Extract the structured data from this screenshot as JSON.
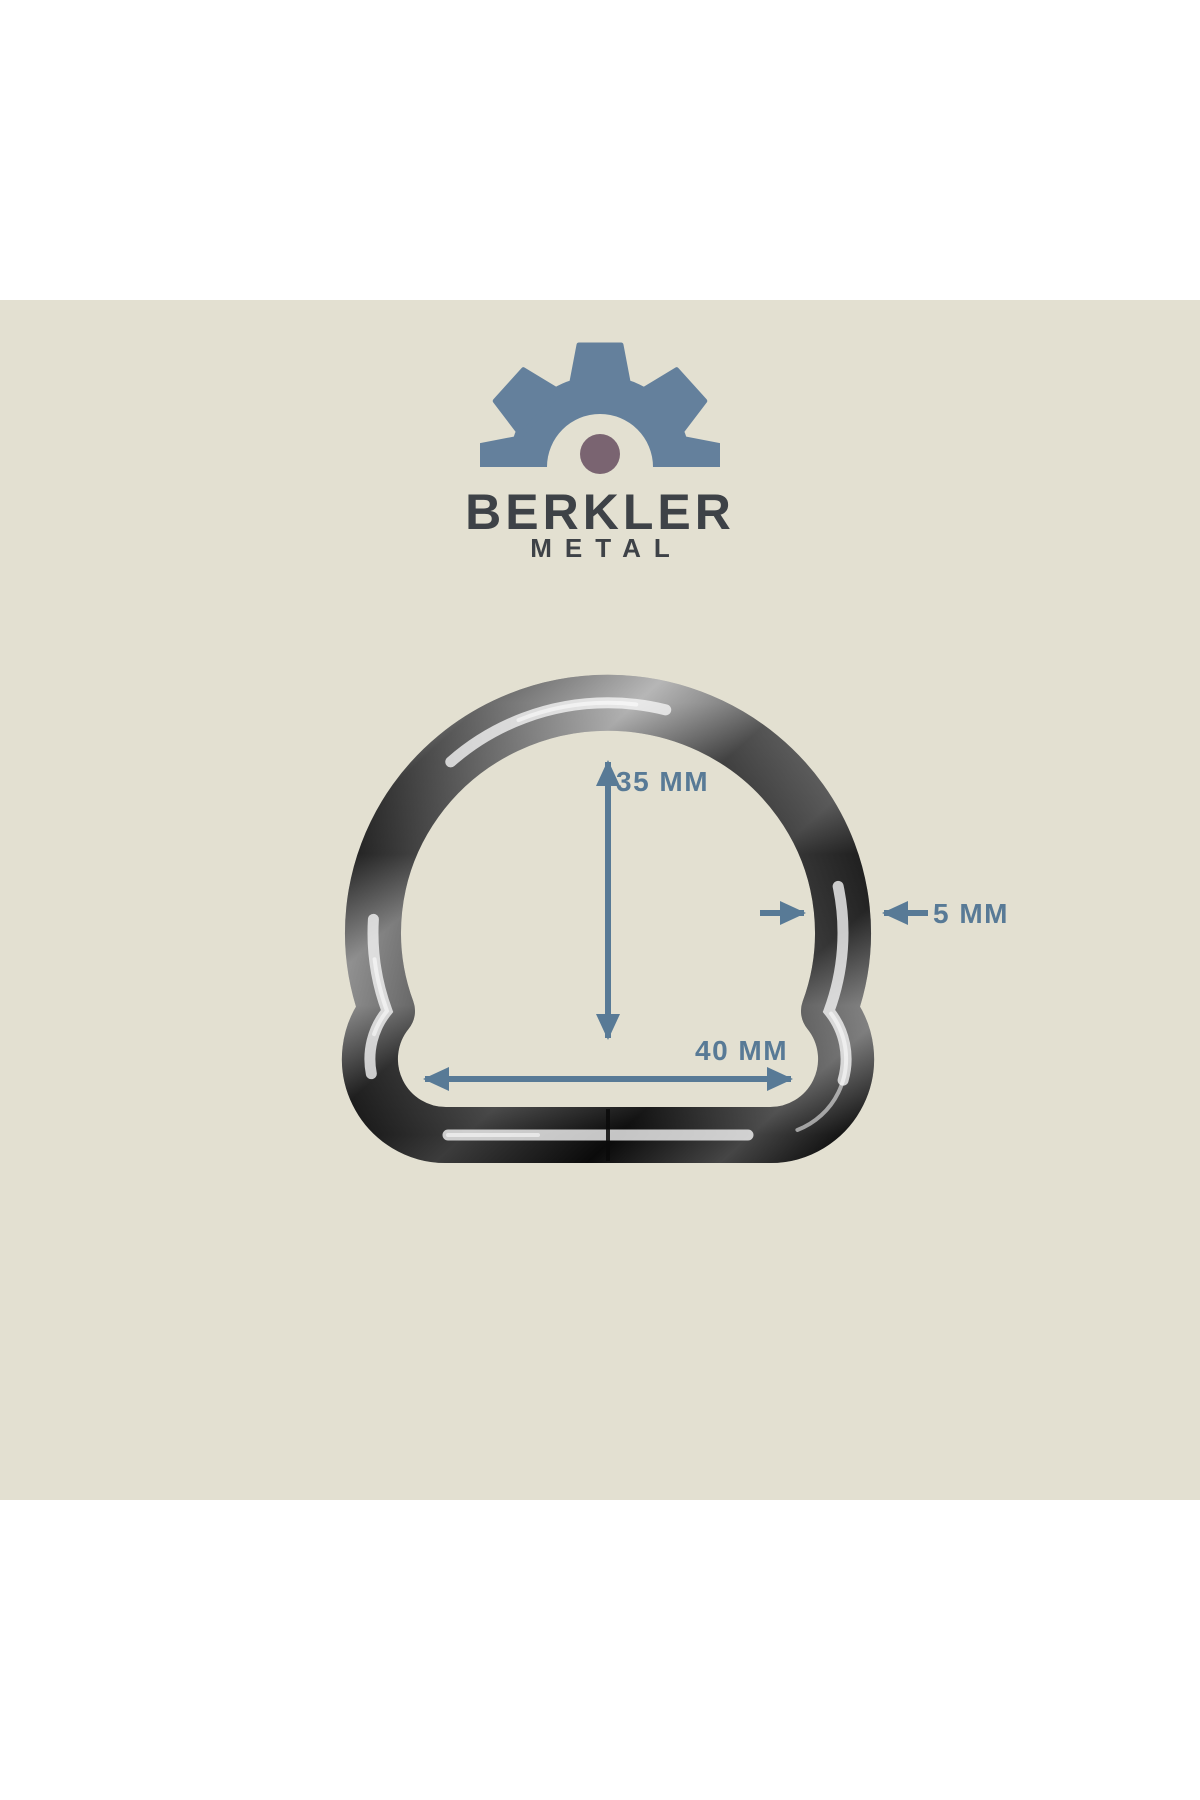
{
  "colors": {
    "page": "#ffffff",
    "panel": "#e3e0d1",
    "accent": "#587a96",
    "gear": "#64809c",
    "dot": "#7a6471",
    "logoText": "#3e4247"
  },
  "brand": {
    "name": "BERKLER",
    "tagline": "METAL"
  },
  "dimensions": {
    "height": "35 MM",
    "width": "40 MM",
    "thickness": "5 MM"
  }
}
